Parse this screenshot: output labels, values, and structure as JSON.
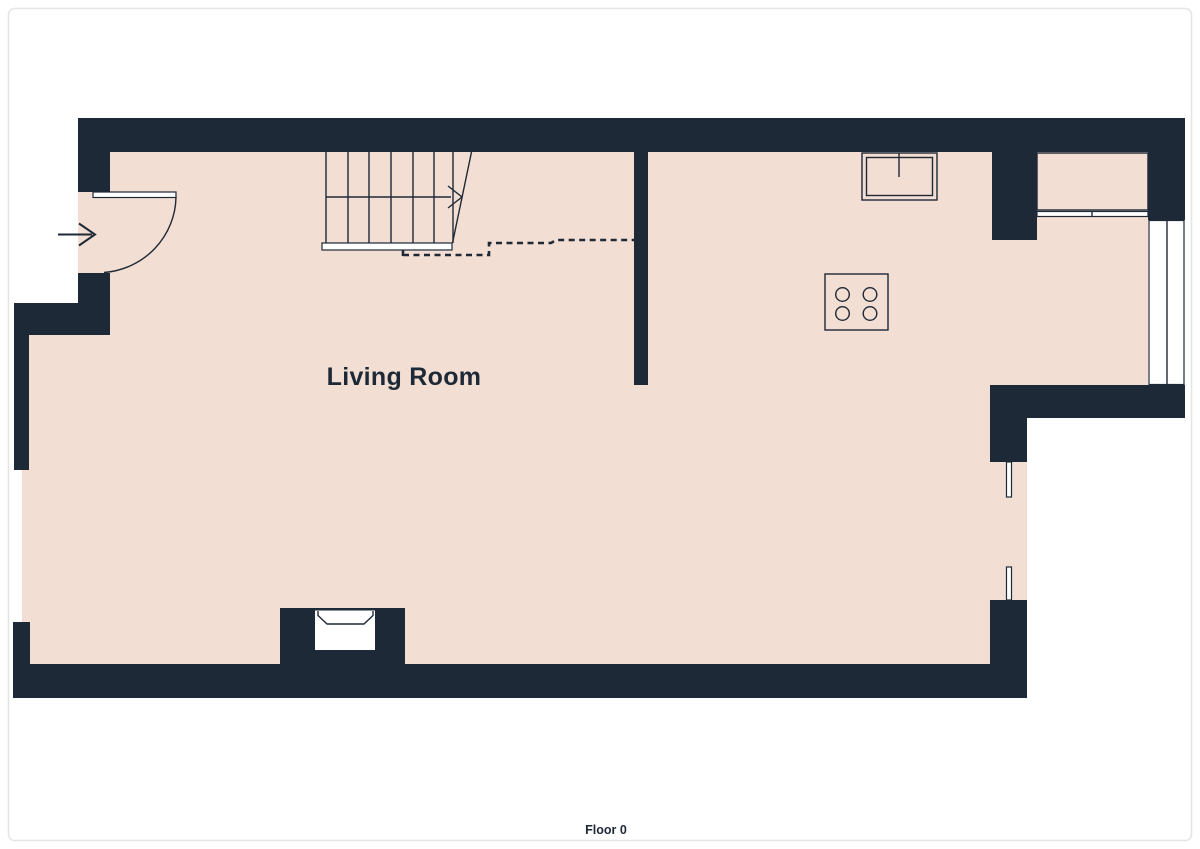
{
  "labels": {
    "living_room": "Living Room",
    "floor": "Floor 0"
  },
  "colors": {
    "wall": "#1e2937",
    "floor": "#f2ded2",
    "counter": "#d1d5d6",
    "background": "#ffffff",
    "border": "#e5e5e5",
    "text": "#1e2937"
  },
  "fixtures": [
    "staircase",
    "stair-direction-arrow",
    "ceiling-opening-dashed-line",
    "entry-door",
    "entry-arrow",
    "kitchen-sink",
    "cooktop",
    "kitchen-counter",
    "window",
    "wall-opening-jambs",
    "fireplace"
  ]
}
